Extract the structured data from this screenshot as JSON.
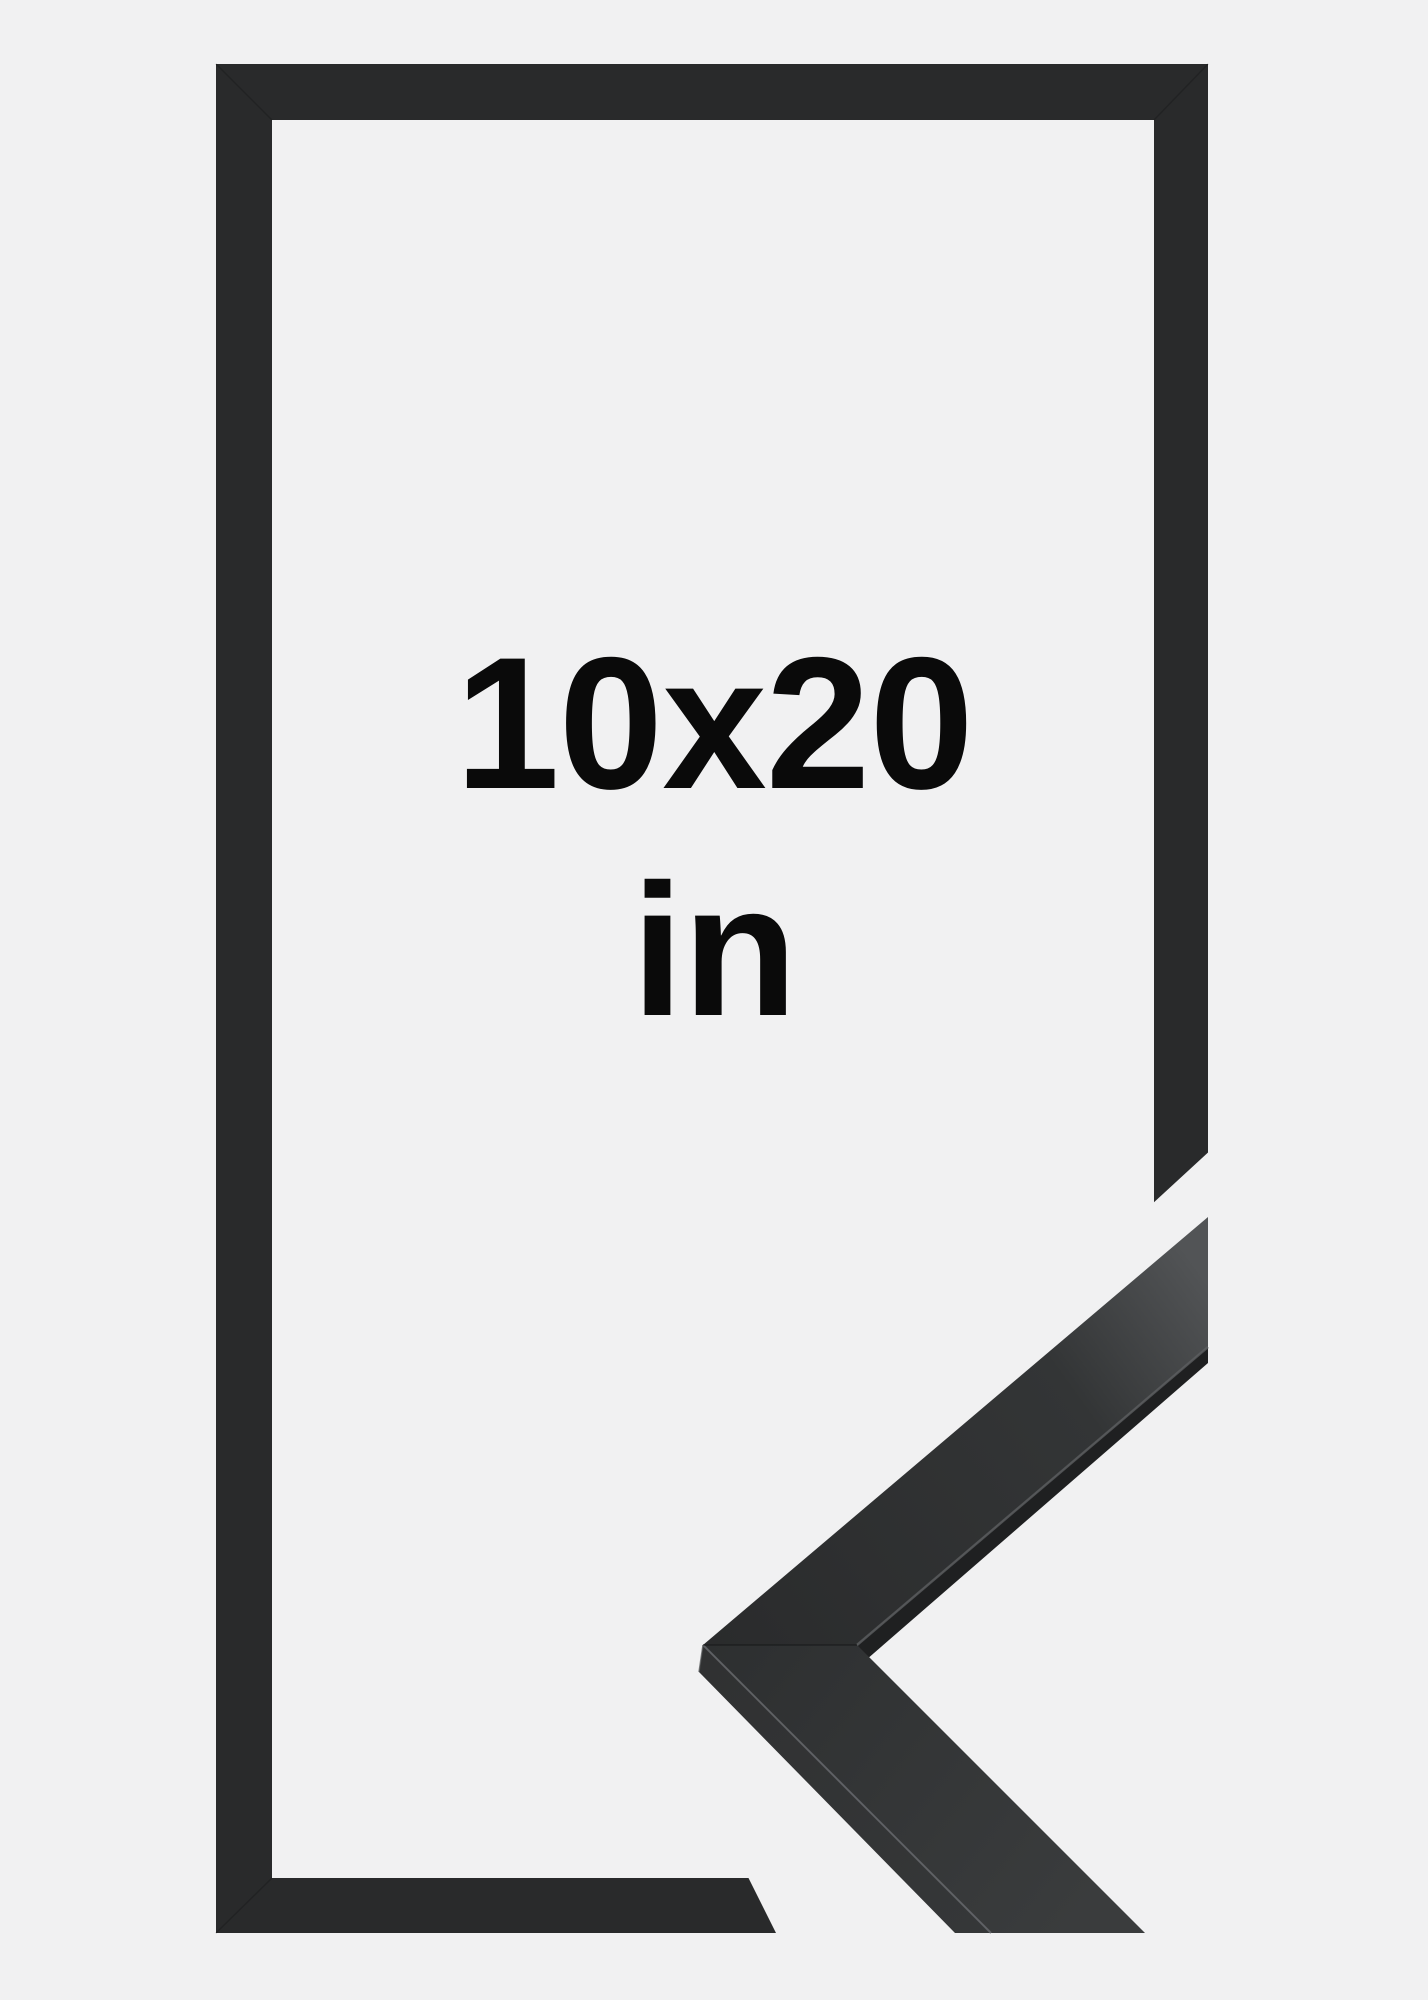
{
  "product_image": {
    "size_label": "10x20",
    "unit_label": "in",
    "description": "Black picture frame product photo with mitred corner profile sample piece",
    "colors": {
      "background": "#f1f1f2",
      "frame": "#292a2b",
      "frame_mitre_line": "#151617",
      "sample_face_dark": "#2a2b2c",
      "sample_face_light": "#525456",
      "sample_lower_dark": "#2d2f30",
      "sample_lower_light": "#3a3c3d",
      "sample_side_facet": "#353738",
      "sample_inner_shadow": "#1f2021",
      "edge_highlight": "#64666a",
      "inner_edge_highlight": "#5c5e60",
      "text": "#0a0a0a"
    }
  }
}
